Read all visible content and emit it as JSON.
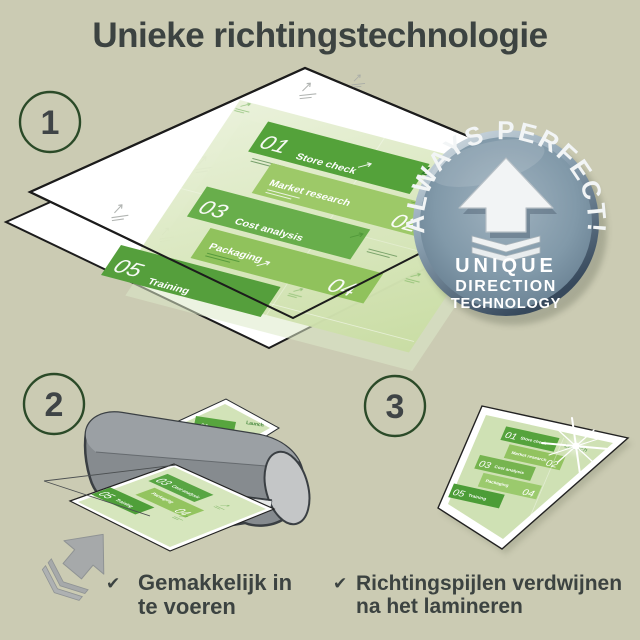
{
  "title": "Unieke richtingstechnologie",
  "steps": {
    "one": "1",
    "two": "2",
    "three": "3"
  },
  "badge": {
    "arc_text": "ALWAYS PERFECT!",
    "line1": "UNIQUE",
    "line2": "DIRECTION",
    "line3": "TECHNOLOGY"
  },
  "doc": {
    "launch": "Launch",
    "items": [
      {
        "num": "01",
        "label": "Store check"
      },
      {
        "num": "02",
        "label": "Market research"
      },
      {
        "num": "03",
        "label": "Cost analysis"
      },
      {
        "num": "04",
        "label": "Packaging"
      },
      {
        "num": "05",
        "label": "Training"
      }
    ]
  },
  "checklist": [
    {
      "check": "✔",
      "lines": [
        "Gemakkelijk in",
        "te voeren"
      ]
    },
    {
      "check": "✔",
      "lines": [
        "Richtingspijlen verdwijnen",
        "na het lamineren"
      ]
    }
  ],
  "colors": {
    "background": "#cbcbb3",
    "text_dark": "#3c4341",
    "circle_ring": "#2b4a28",
    "sheet_outline": "#1c1c1c",
    "doc_pale": "#d7e6bb",
    "block_dark_green": "#54a23a",
    "block_mid_green": "#9dc968",
    "badge_face": "#8199a9",
    "badge_rim_dark": "#3d5468",
    "machine_gray": "#868b8f",
    "arrow_gray": "#a6a9aa"
  }
}
